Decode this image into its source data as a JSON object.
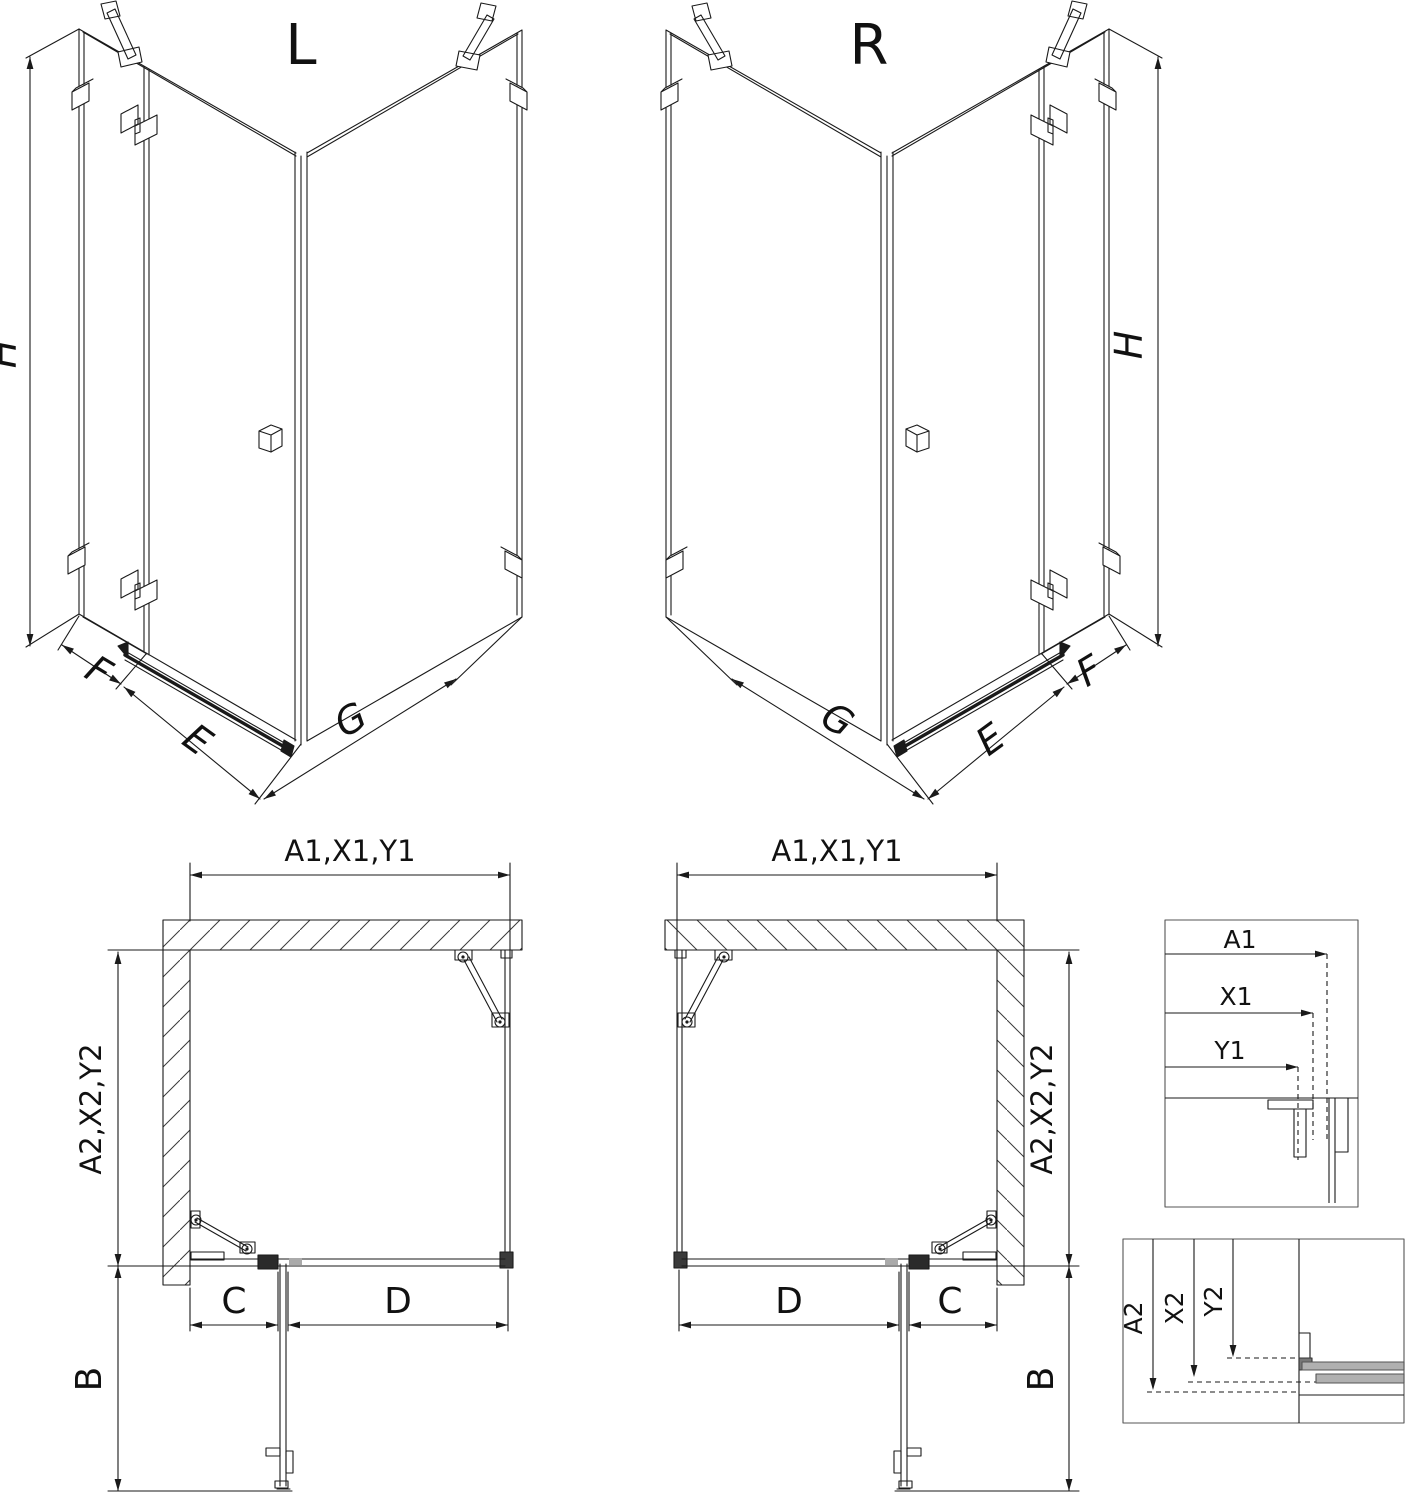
{
  "colors": {
    "line": "#1a1a1a",
    "hatch": "#3a3a3a",
    "profile_gray": "#b0b0b0",
    "background": "#ffffff"
  },
  "labels": {
    "iso_left": {
      "title": "L",
      "height": "H",
      "panel_f": "F",
      "panel_e": "E",
      "panel_g": "G"
    },
    "iso_right": {
      "title": "R",
      "height": "H",
      "panel_f": "F",
      "panel_e": "E",
      "panel_g": "G"
    },
    "plan_left": {
      "width_top": "A1,X1,Y1",
      "depth_side": "A2,X2,Y2",
      "seg_c": "C",
      "seg_d": "D",
      "seg_b": "B"
    },
    "plan_right": {
      "width_top": "A1,X1,Y1",
      "depth_side": "A2,X2,Y2",
      "seg_c": "C",
      "seg_d": "D",
      "seg_b": "B"
    },
    "detail_width": {
      "a1": "A1",
      "x1": "X1",
      "y1": "Y1"
    },
    "detail_depth": {
      "a2": "A2",
      "x2": "X2",
      "y2": "Y2"
    }
  }
}
